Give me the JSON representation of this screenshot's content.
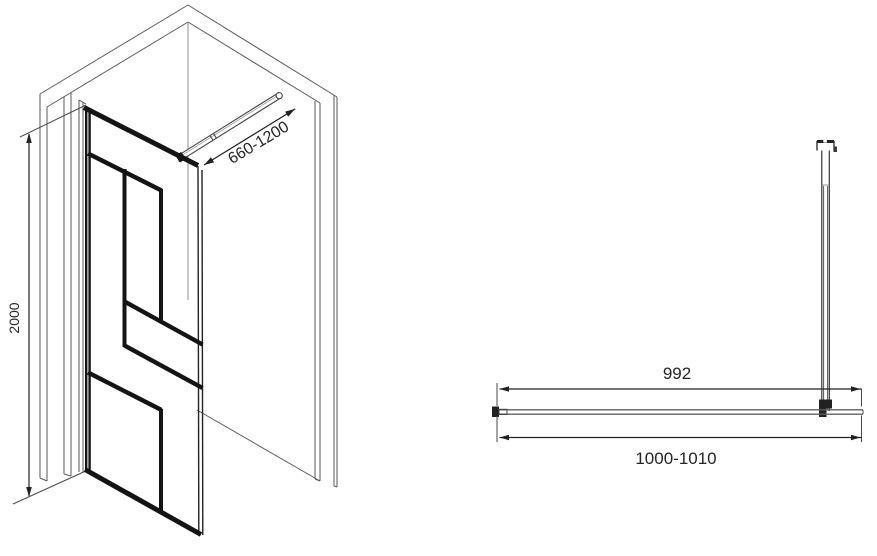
{
  "drawing": {
    "isometric_view": {
      "support_bar_length_range": "660-1200",
      "panel_height": "2000"
    },
    "top_view": {
      "glass_width": "992",
      "overall_width_range": "1000-1010"
    },
    "colors": {
      "background": "#ffffff",
      "frame_black": "#141414",
      "wall_line_gray": "#555555",
      "dimension_gray": "#222222"
    }
  }
}
